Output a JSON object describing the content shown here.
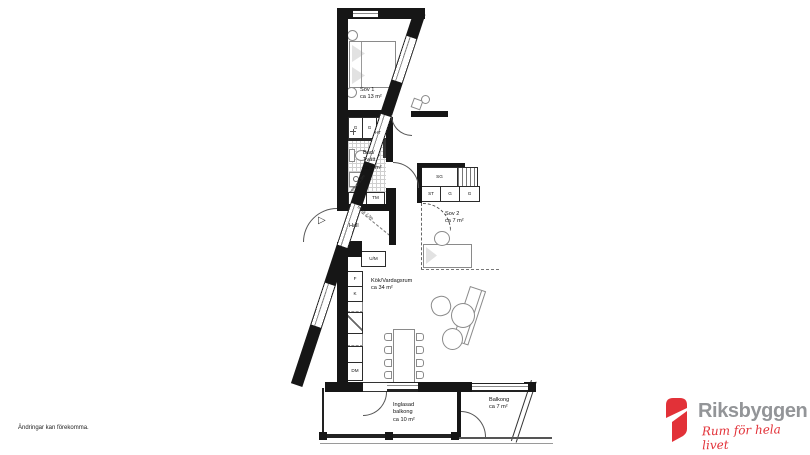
{
  "page": {
    "background": "#ffffff",
    "wall_color": "#161616",
    "accent_red": "#e23138",
    "brand_gray": "#939598"
  },
  "disclaimer": "Ändringar kan förekomma.",
  "logo": {
    "brand": "Riksbyggen",
    "tagline": "Rum för hela livet",
    "mark": "riksbyggen-ribbon-icon"
  },
  "rooms": {
    "sov1": {
      "name": "Sov 1",
      "area": "ca 13 m²"
    },
    "bad": {
      "l1": "Bad/",
      "l2": "Tvätt",
      "area": "ca 5 m²"
    },
    "hall": {
      "name": "Hall"
    },
    "sov2": {
      "name": "Sov 2",
      "area": "ca 7 m²"
    },
    "kok": {
      "name": "Kök/Vardagsrum",
      "area": "ca 34 m²"
    },
    "inglasad": {
      "l1": "Inglasad",
      "l2": "balkong",
      "area": "ca 10 m²"
    },
    "balkong": {
      "name": "Balkong",
      "area": "ca 7 m²"
    }
  },
  "annotations": {
    "hall_height": "frh ca 2,3m",
    "bad_height": "frh ca 2,3m"
  },
  "cabinets": {
    "g1": "G",
    "g2": "G",
    "l": "L",
    "tt": "TT",
    "tm": "TM",
    "um": "U/M",
    "f": "F",
    "k": "K",
    "dm": "DM",
    "ht": "HT",
    "sg": "SG",
    "st": "ST",
    "g3": "G",
    "g4": "G"
  }
}
